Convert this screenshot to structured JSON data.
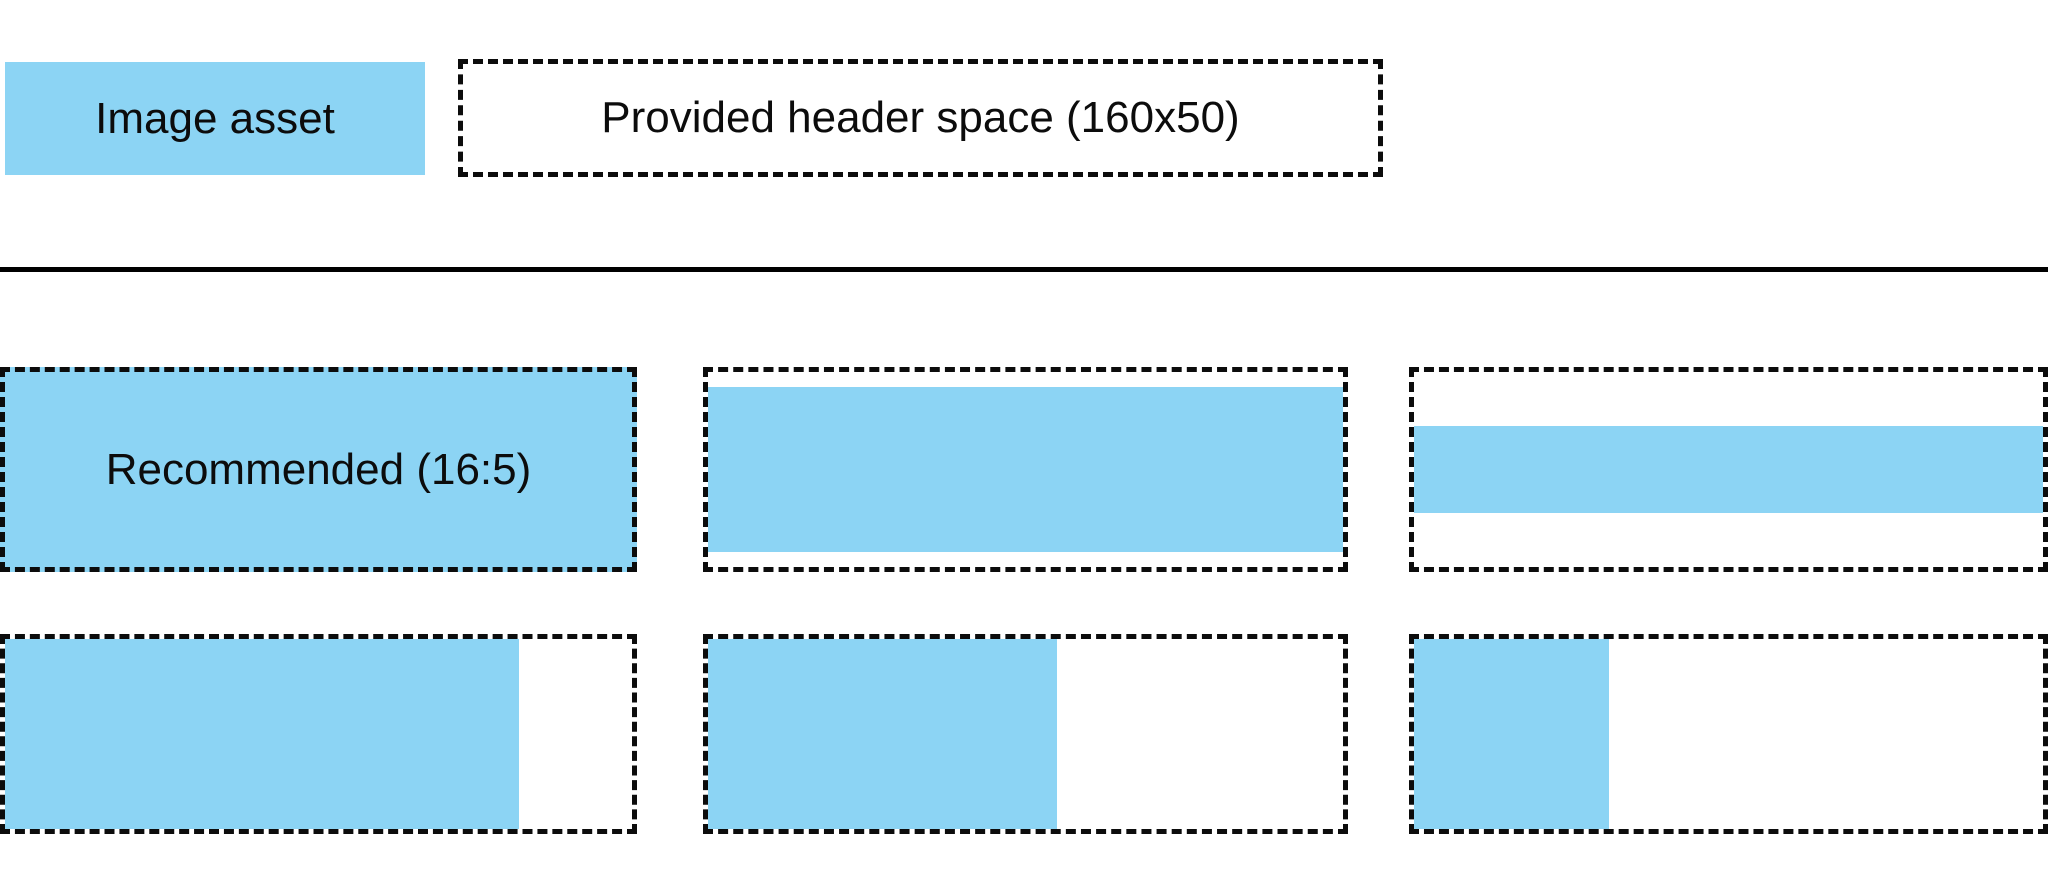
{
  "colors": {
    "image_asset_fill": "#8CD4F4",
    "outline": "#0c0c0c",
    "background": "#ffffff"
  },
  "legend": {
    "image_asset": {
      "label": "Image asset"
    },
    "header_space": {
      "label": "Provided header space (160x50)"
    }
  },
  "examples": {
    "row1": [
      {
        "name": "recommended-16-5",
        "label": "Recommended (16:5)",
        "fill_width": "100%",
        "fill_height": "100%"
      },
      {
        "name": "full-width-near-full-height",
        "fill_width": "100%",
        "fill_height": "85%"
      },
      {
        "name": "full-width-band",
        "fill_width": "100%",
        "fill_height": "45%"
      }
    ],
    "row2": [
      {
        "name": "full-height-wide",
        "fill_width": "82%",
        "fill_height": "100%"
      },
      {
        "name": "full-height-medium",
        "fill_width": "55%",
        "fill_height": "100%"
      },
      {
        "name": "full-height-narrow",
        "fill_width": "31%",
        "fill_height": "100%"
      }
    ]
  }
}
